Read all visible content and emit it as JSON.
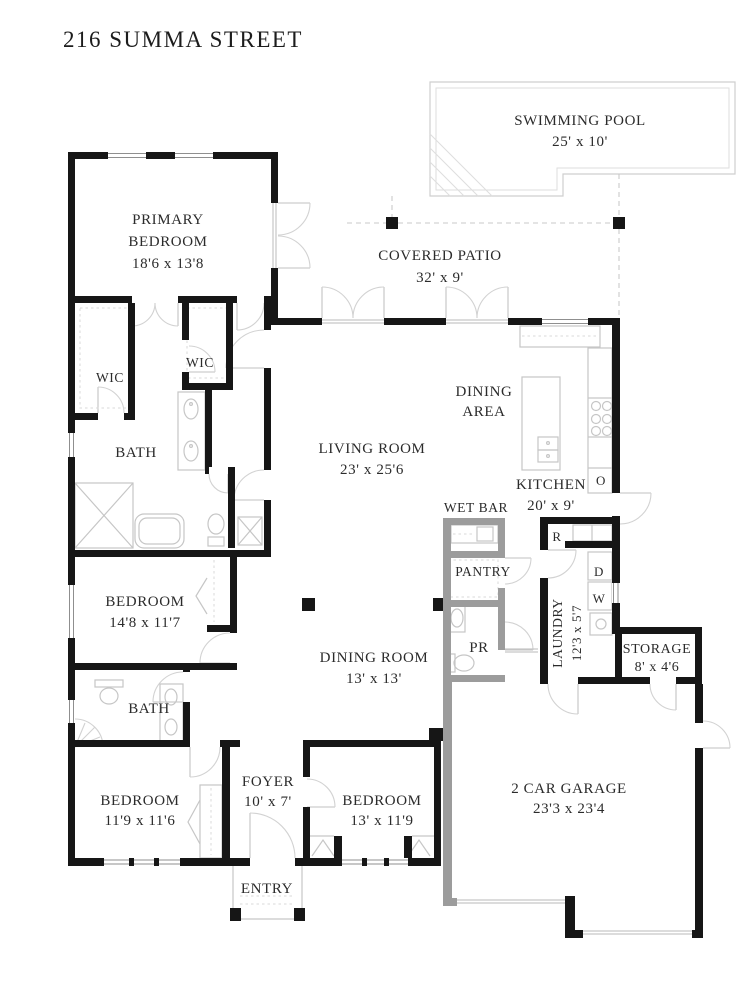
{
  "title": "216 SUMMA STREET",
  "rooms": {
    "pool": {
      "name": "SWIMMING POOL",
      "dims": "25' x 10'"
    },
    "patio": {
      "name": "COVERED PATIO",
      "dims": "32' x 9'"
    },
    "primary_bedroom": {
      "name_line1": "PRIMARY",
      "name_line2": "BEDROOM",
      "dims": "18'6 x 13'8"
    },
    "wic1": {
      "name": "WIC"
    },
    "wic2": {
      "name": "WIC"
    },
    "primary_bath": {
      "name": "BATH"
    },
    "living": {
      "name": "LIVING ROOM",
      "dims": "23' x 25'6"
    },
    "dining_area": {
      "name_line1": "DINING",
      "name_line2": "AREA"
    },
    "kitchen": {
      "name": "KITCHEN",
      "dims": "20' x 9'"
    },
    "wet_bar": {
      "name": "WET BAR"
    },
    "pantry": {
      "name": "PANTRY"
    },
    "powder_room": {
      "name": "PR"
    },
    "bedroom2": {
      "name": "BEDROOM",
      "dims": "14'8 x 11'7"
    },
    "bath2": {
      "name": "BATH"
    },
    "dining_room": {
      "name": "DINING ROOM",
      "dims": "13' x 13'"
    },
    "laundry": {
      "name": "LAUNDRY",
      "dims": "12'3 x 5'7"
    },
    "storage": {
      "name": "STORAGE",
      "dims": "8' x 4'6"
    },
    "bedroom3": {
      "name": "BEDROOM",
      "dims": "11'9 x 11'6"
    },
    "bedroom4": {
      "name": "BEDROOM",
      "dims": "13' x 11'9"
    },
    "foyer": {
      "name": "FOYER",
      "dims": "10' x 7'"
    },
    "entry": {
      "name": "ENTRY"
    },
    "garage": {
      "name": "2 CAR GARAGE",
      "dims": "23'3 x 23'4"
    }
  },
  "appliances": {
    "oven": "O",
    "refrigerator": "R",
    "dryer": "D",
    "washer": "W"
  },
  "colors": {
    "wall": "#161616",
    "gray_wall": "#9c9c9c",
    "fixture": "#c6c6c6",
    "pool_outline": "#cfcfcf",
    "text": "#2b2b2b"
  }
}
